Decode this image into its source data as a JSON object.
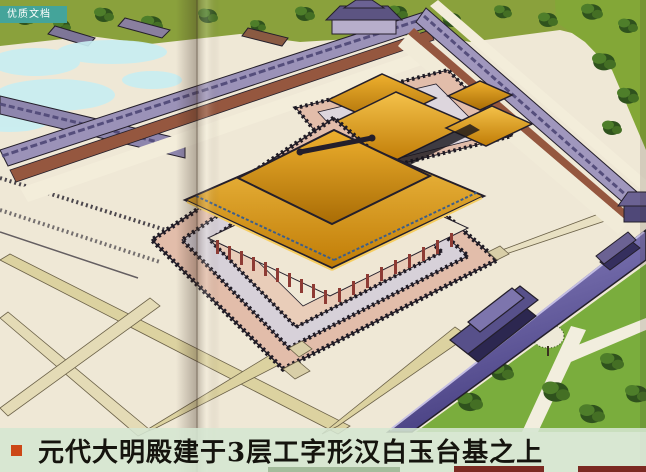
{
  "watermark": {
    "label": "优质文档"
  },
  "caption": {
    "bullet": "square",
    "text": "元代大明殿建于3层工字形汉白玉台基之上"
  },
  "colors": {
    "ribbon_teal": "#44a49a",
    "bullet_red": "#cc4716",
    "band_green": "#d5e6d1",
    "caption_ink": "#15140e",
    "roof_gold": "#d6990f",
    "marble_pink": "#e2bdaa",
    "marble_gray": "#d7d1d9",
    "wall_purple": "#736bae",
    "corridor_purple": "#9b92b8",
    "brick_red": "#95573f",
    "lawn_green": "#7aad3d",
    "path_beige": "#dcd2a0",
    "mist_cyan": "#c8eef2",
    "ink": "#241f2b"
  }
}
